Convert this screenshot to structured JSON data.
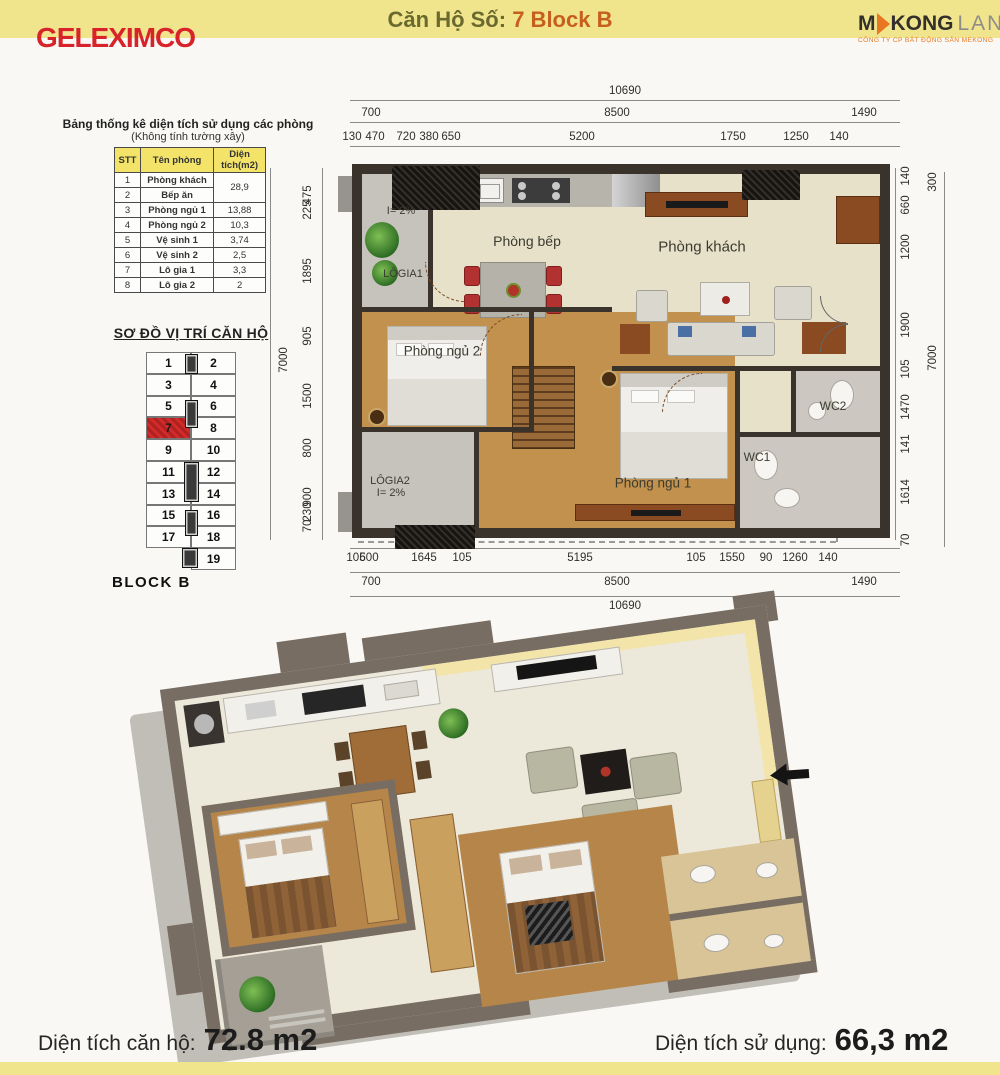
{
  "header": {
    "logo_text": "GELEXIMCO",
    "title_prefix": "Căn Hộ Số:",
    "title_unit": "7 Block B",
    "mekong": {
      "m": "M",
      "kong": "KONG",
      "land": "LAND",
      "subtitle": "CÔNG TY CP BẤT ĐỘNG SẢN MEKONG"
    }
  },
  "area_table": {
    "title": "Bảng thống kê diện tích sử dụng các phòng",
    "subtitle": "(Không tính tường xây)",
    "columns": [
      "STT",
      "Tên phòng",
      "Diện tích(m2)"
    ],
    "merged_area_rows_1_2": "28,9",
    "rows": [
      {
        "stt": "1",
        "name": "Phòng khách",
        "area": ""
      },
      {
        "stt": "2",
        "name": "Bếp ăn",
        "area": ""
      },
      {
        "stt": "3",
        "name": "Phòng ngủ 1",
        "area": "13,88"
      },
      {
        "stt": "4",
        "name": "Phòng ngủ 2",
        "area": "10,3"
      },
      {
        "stt": "5",
        "name": "Vệ sinh 1",
        "area": "3,74"
      },
      {
        "stt": "6",
        "name": "Vệ sinh 2",
        "area": "2,5"
      },
      {
        "stt": "7",
        "name": "Lô gia 1",
        "area": "3,3"
      },
      {
        "stt": "8",
        "name": "Lô gia 2",
        "area": "2"
      }
    ]
  },
  "location": {
    "title": "SƠ ĐỒ VỊ TRÍ CĂN HỘ",
    "block": "BLOCK B",
    "highlight_unit": "7",
    "rows": [
      [
        "1",
        "2"
      ],
      [
        "3",
        "4"
      ],
      [
        "5",
        "6"
      ],
      [
        "7",
        "8"
      ],
      [
        "9",
        "10"
      ],
      [
        "11",
        "12"
      ],
      [
        "13",
        "14"
      ],
      [
        "15",
        "16"
      ],
      [
        "17",
        "18"
      ],
      [
        "",
        "19"
      ]
    ]
  },
  "floor_plan": {
    "rooms": {
      "kitchen": "Phòng bếp",
      "living": "Phòng khách",
      "bedroom2": "Phòng ngủ 2",
      "bedroom1": "Phòng ngủ 1",
      "wc1": "WC1",
      "wc2": "WC2",
      "logia1": "LÔGIA1",
      "logia1_slope": "I= 2%",
      "logia2": "LÔGIA2",
      "logia2_slope": "I= 2%"
    },
    "dims": {
      "top_total": "10690",
      "top_mid": [
        "700",
        "8500",
        "1490"
      ],
      "top_detail": [
        "130",
        "470",
        "720",
        "380",
        "650",
        "5200",
        "1750",
        "1250",
        "140"
      ],
      "bottom_detail": [
        "105",
        "600",
        "1645",
        "105",
        "5195",
        "105",
        "1550",
        "90",
        "1260",
        "140"
      ],
      "bottom_mid": [
        "700",
        "8500",
        "1490"
      ],
      "bottom_total": "10690",
      "left_detail": [
        "475",
        "225",
        "1895",
        "905",
        "1500",
        "800",
        "900",
        "230",
        "70"
      ],
      "left_total": "7000",
      "right_detail": [
        "140",
        "660",
        "1200",
        "1900",
        "105",
        "1470",
        "141",
        "1614",
        "70"
      ],
      "right_outer_top": "300",
      "right_total": "7000"
    }
  },
  "footer": {
    "left_label": "Diện tích căn hộ:",
    "left_value": "72.8 m2",
    "right_label": "Diện tích sử dụng:",
    "right_value": "66,3 m2"
  },
  "colors": {
    "band_yellow": "#f0e48c",
    "geleximco_red": "#d8232a",
    "title_olive": "#6a6a2e",
    "title_orange": "#c65f1e",
    "unit_highlight_red": "#d42a2a",
    "mekong_orange": "#e87722",
    "wall_dark": "#3a332c",
    "floor_beige": "#e8e1ca",
    "floor_wood": "#c2914d"
  }
}
